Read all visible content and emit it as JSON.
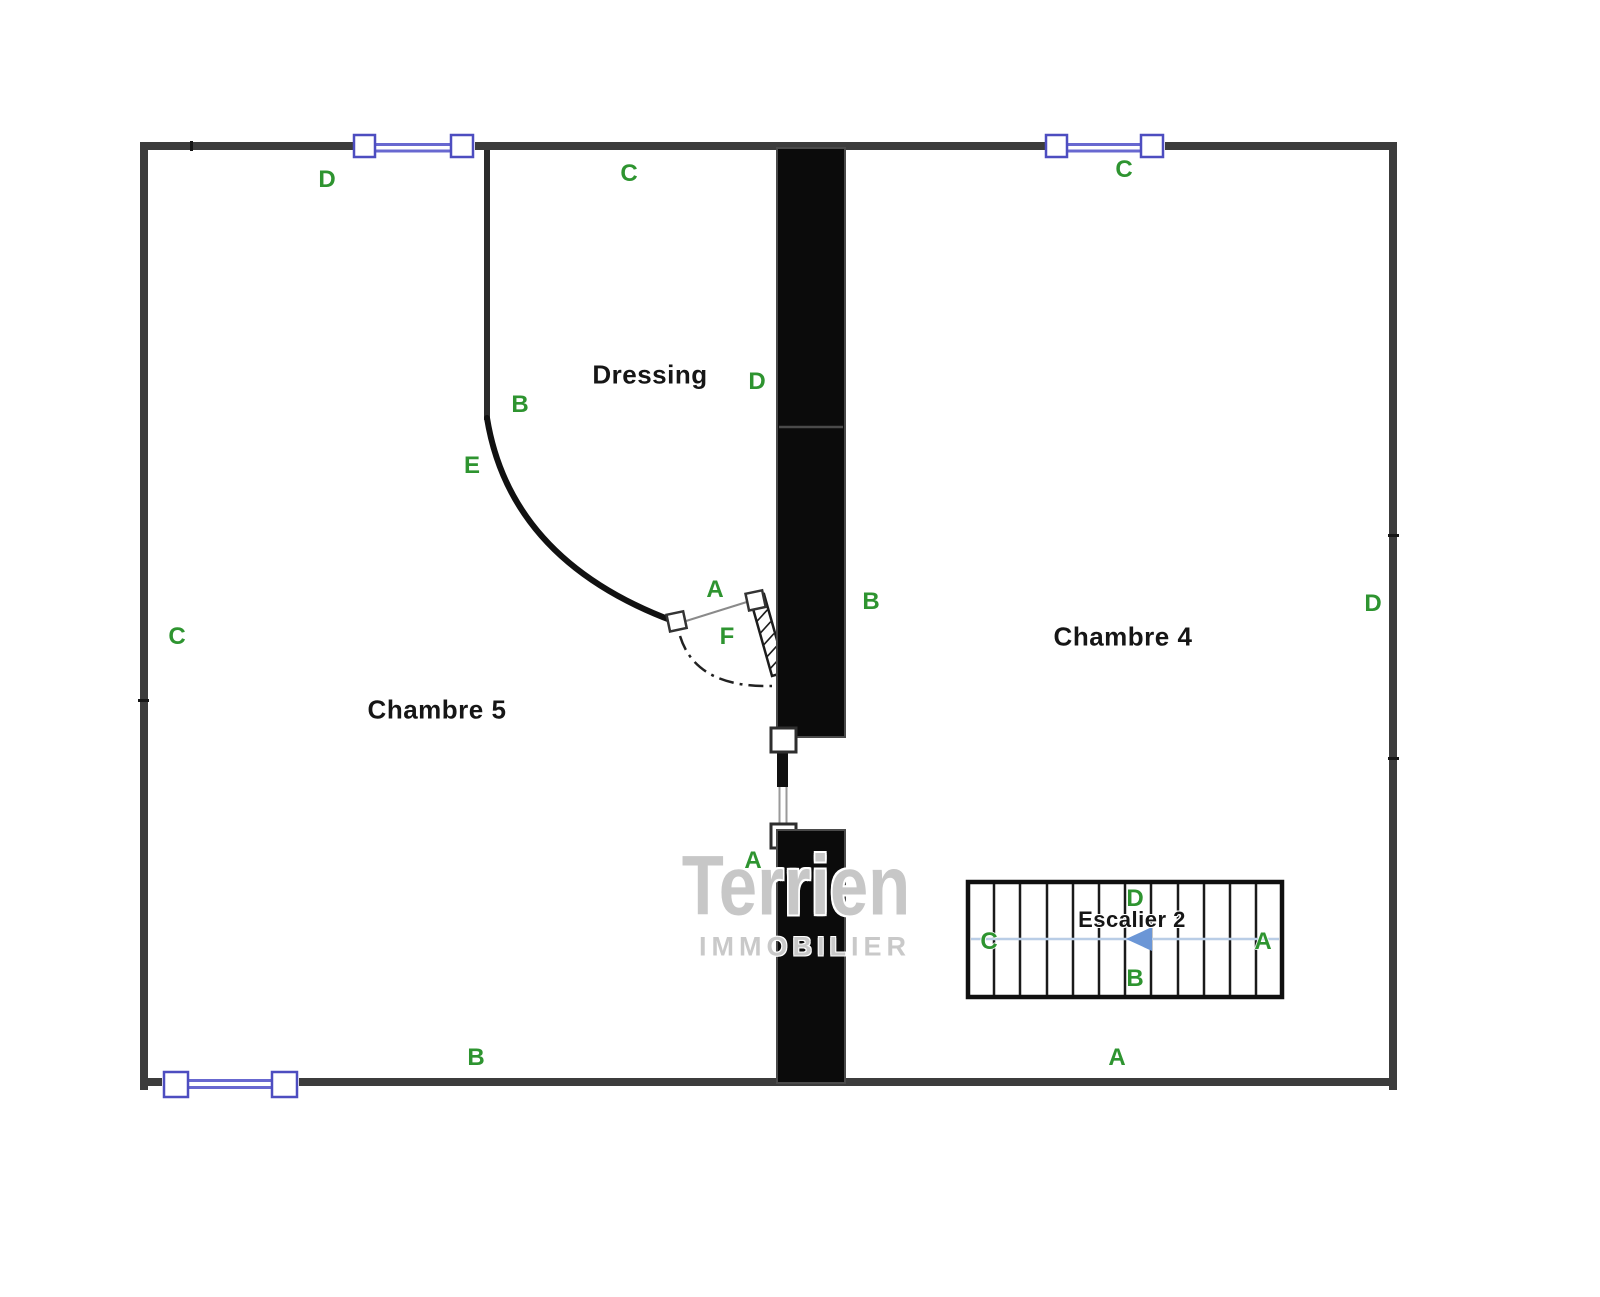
{
  "plan_title": "Floor plan - level with Chambre 4, Chambre 5, Dressing, Escalier 2",
  "rooms": {
    "chambre5": {
      "label": "Chambre 5"
    },
    "chambre4": {
      "label": "Chambre 4"
    },
    "dressing": {
      "label": "Dressing"
    },
    "stairs": {
      "label": "Escalier 2",
      "treads": 12,
      "arrow_direction": "left"
    }
  },
  "markers": [
    {
      "text": "D",
      "location": "top-wall-left"
    },
    {
      "text": "C",
      "location": "top-wall-center"
    },
    {
      "text": "C",
      "location": "top-wall-right"
    },
    {
      "text": "B",
      "location": "dressing-west-wall"
    },
    {
      "text": "E",
      "location": "curved-wall"
    },
    {
      "text": "D",
      "location": "dressing-east-wall"
    },
    {
      "text": "A",
      "location": "dressing-door"
    },
    {
      "text": "F",
      "location": "door-swing"
    },
    {
      "text": "B",
      "location": "chambre4-west-wall"
    },
    {
      "text": "C",
      "location": "left-wall"
    },
    {
      "text": "D",
      "location": "right-wall"
    },
    {
      "text": "A",
      "location": "central-passage"
    },
    {
      "text": "B",
      "location": "bottom-wall-left"
    },
    {
      "text": "A",
      "location": "bottom-wall-right"
    },
    {
      "text": "C",
      "location": "stair-left"
    },
    {
      "text": "A",
      "location": "stair-right"
    },
    {
      "text": "D",
      "location": "stair-top"
    },
    {
      "text": "B",
      "location": "stair-bottom"
    }
  ],
  "watermark": {
    "line1": "Terrien",
    "line2": "IMMOBILIER"
  },
  "colors": {
    "marker_green": "#2e9430",
    "wall_gray": "#3c3c3c",
    "filled_wall_black": "#0b0b0b",
    "window_line_blue": "#6868d0",
    "window_frame_blue": "#4d4dc0",
    "stair_axis_blue": "#b9cde6",
    "stair_arrow_blue": "#6b96d6",
    "watermark_gray": "#c7c7c7"
  }
}
